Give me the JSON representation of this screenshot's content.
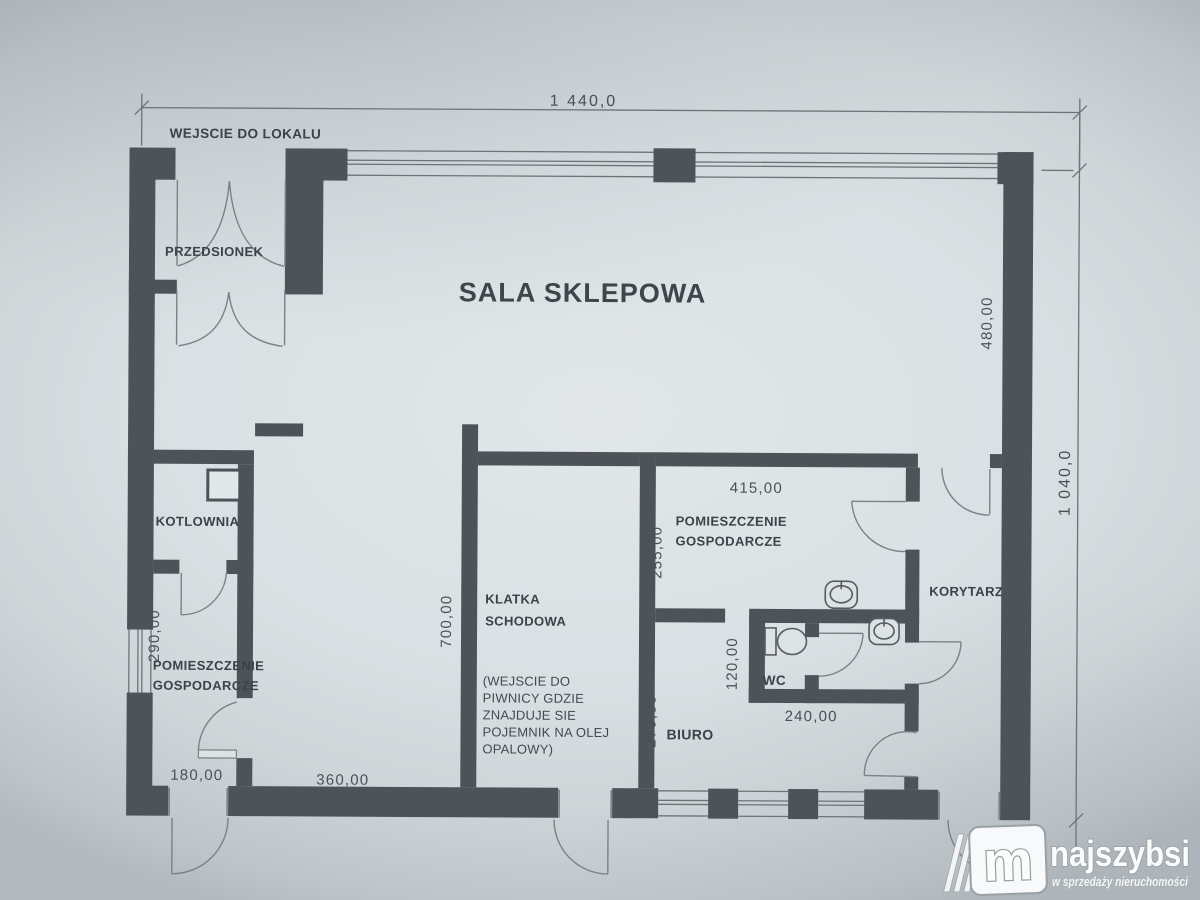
{
  "plan": {
    "entrance_note": "WEJSCIE DO LOKALU",
    "rooms": {
      "przedsionek": "PRZEDSIONEK",
      "sala": "SALA SKLEPOWA",
      "kotlownia": "KOTLOWNIA",
      "pg_left": {
        "l1": "POMIESZCZENIE",
        "l2": "GOSPODARCZE"
      },
      "klatka": {
        "l1": "KLATKA",
        "l2": "SCHODOWA"
      },
      "pg_right": {
        "l1": "POMIESZCZENIE",
        "l2": "GOSPODARCZE"
      },
      "korytarz": "KORYTARZ",
      "wc": "WC",
      "biuro": "BIURO"
    },
    "dims": {
      "total_width": "1 440,0",
      "total_height": "1 040,0",
      "d480": "480,00",
      "d415": "415,00",
      "d255": "255,00",
      "d700": "700,00",
      "d290": "290,00",
      "d120": "120,00",
      "d240": "240,00",
      "d270": "270,00",
      "d180": "180,00",
      "d360": "360,00"
    },
    "basement_note": {
      "lines": [
        "(WEJSCIE DO",
        "PIWNICY GDZIE",
        "ZNAJDUJE SIE",
        "POJEMNIK NA OLEJ",
        "OPALOWY)"
      ]
    }
  },
  "watermark": {
    "monogram": "m",
    "brand": "najszybsi",
    "tagline": "w sprzedaży nieruchomości"
  },
  "colors": {
    "wall": "#4d5358",
    "background": "#dae0e3",
    "line": "#6d7478",
    "text": "#3b4248"
  }
}
